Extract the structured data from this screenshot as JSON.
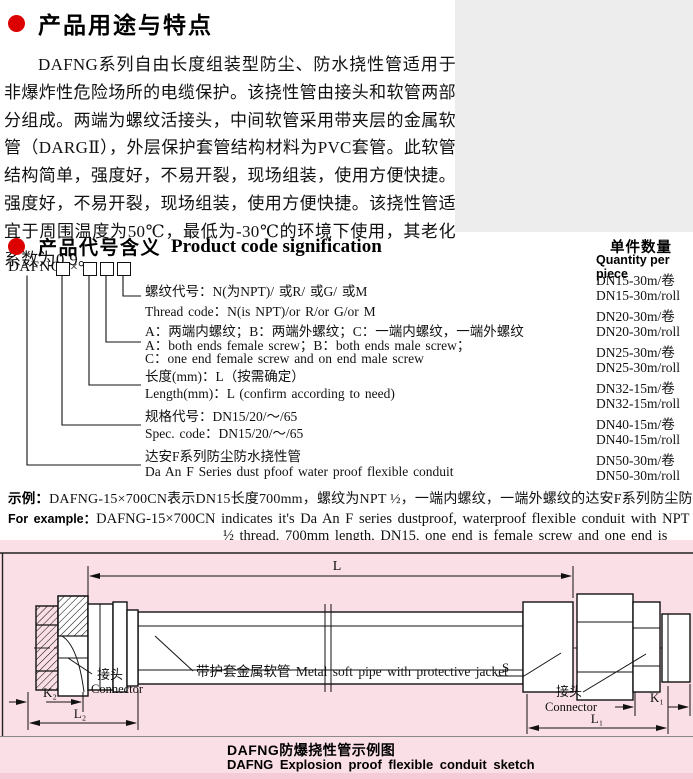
{
  "section1": {
    "title": "产品用途与特点",
    "body": "DAFNG系列自由长度组装型防尘、防水挠性管适用于非爆炸性危险场所的电缆保护。该挠性管由接头和软管两部分组成。两端为螺纹活接头，中间软管采用带夹层的金属软管（DARGⅡ），外层保护套管结构材料为PVC套管。此软管结构简单，强度好，不易开裂，现场组装，使用方便快捷。强度好，不易开裂，现场组装，使用方便快捷。该挠性管适宜于周围温度为50℃，最低为-30℃的环境下使用，其老化系数为0.9。"
  },
  "section2": {
    "title_cn": "产品代号含义",
    "title_en": "Product code signification",
    "code_prefix": "DAFNG-",
    "code_times": "×",
    "legend": [
      {
        "cn": "螺纹代号：N(为NPT)/ 或R/ 或G/ 或M",
        "en": "Thread code：N(is NPT)/or R/or G/or M"
      },
      {
        "cn": "A：两端内螺纹；B：两端外螺纹；C：一端内螺纹，一端外螺纹",
        "en": "A：both ends female screw；B：both ends male screw；",
        "en2": "C：one end female screw and on end male screw"
      },
      {
        "cn": "长度(mm)：L（按需确定）",
        "en": "Length(mm)：L (confirm according to need)"
      },
      {
        "cn": "规格代号：DN15/20/～/65",
        "en": "Spec. code：DN15/20/～/65"
      },
      {
        "cn": "达安F系列防尘防水挠性管",
        "en": "Da An F Series dust pfoof water proof flexible conduit"
      }
    ]
  },
  "quantity": {
    "title_cn": "单件数量",
    "title_en": "Quantity per piece",
    "items": [
      "DN15-30m/卷",
      "DN15-30m/roll",
      "DN20-30m/卷",
      "DN20-30m/roll",
      "DN25-30m/卷",
      "DN25-30m/roll",
      "DN32-15m/卷",
      "DN32-15m/roll",
      "DN40-15m/卷",
      "DN40-15m/roll",
      "DN50-30m/卷",
      "DN50-30m/roll"
    ]
  },
  "example": {
    "label_cn": "示例：",
    "text_cn": "DAFNG-15×700CN表示DN15长度700mm，螺纹为NPT ½，一端内螺纹，一端外螺纹的达安F系列防尘防水挠性管。",
    "label_en": "For example：",
    "text_en": "DAFNG-15×700CN indicates it's Da An F series dustproof, waterproof flexible conduit with NPT ½ thread, 700mm length, DN15, one end is female screw and one end is male screw."
  },
  "sketch": {
    "dim_l": "L",
    "dim_k1": "K₁",
    "dim_k2": "K₂",
    "dim_l1": "L₁",
    "dim_l2": "L₂",
    "dim_s": "S",
    "connector_cn": "接头",
    "connector_en": "Connector",
    "pipe_label": "带护套金属软管 Metal soft pipe with protective jacket",
    "caption_cn": "DAFNG防爆挠性管示例图",
    "caption_en": "DAFNG Explosion proof flexible conduit sketch"
  }
}
